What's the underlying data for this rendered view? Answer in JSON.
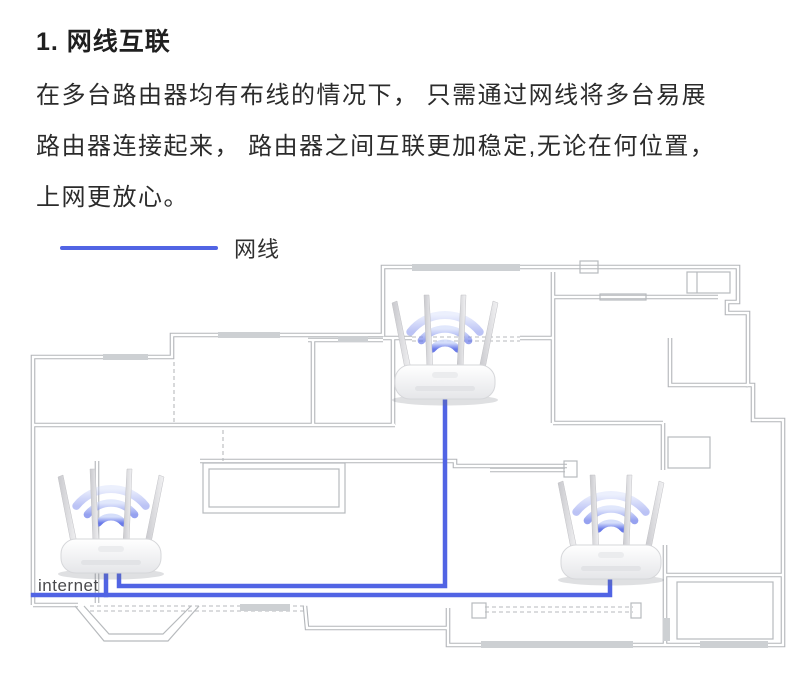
{
  "title": "1. 网线互联",
  "paragraph": {
    "line1": "在多台路由器均有布线的情况下， 只需通过网线将多台易展",
    "line2": "路由器连接起来， 路由器之间互联更加稳定,无论在何位置，",
    "line3": "上网更放心。"
  },
  "legend": {
    "label": "网线",
    "cable_color": "#5164e4"
  },
  "floorplan": {
    "internet_label": "internet",
    "wall_color": "#b2b5b9",
    "window_fill": "#cdd0d3"
  }
}
